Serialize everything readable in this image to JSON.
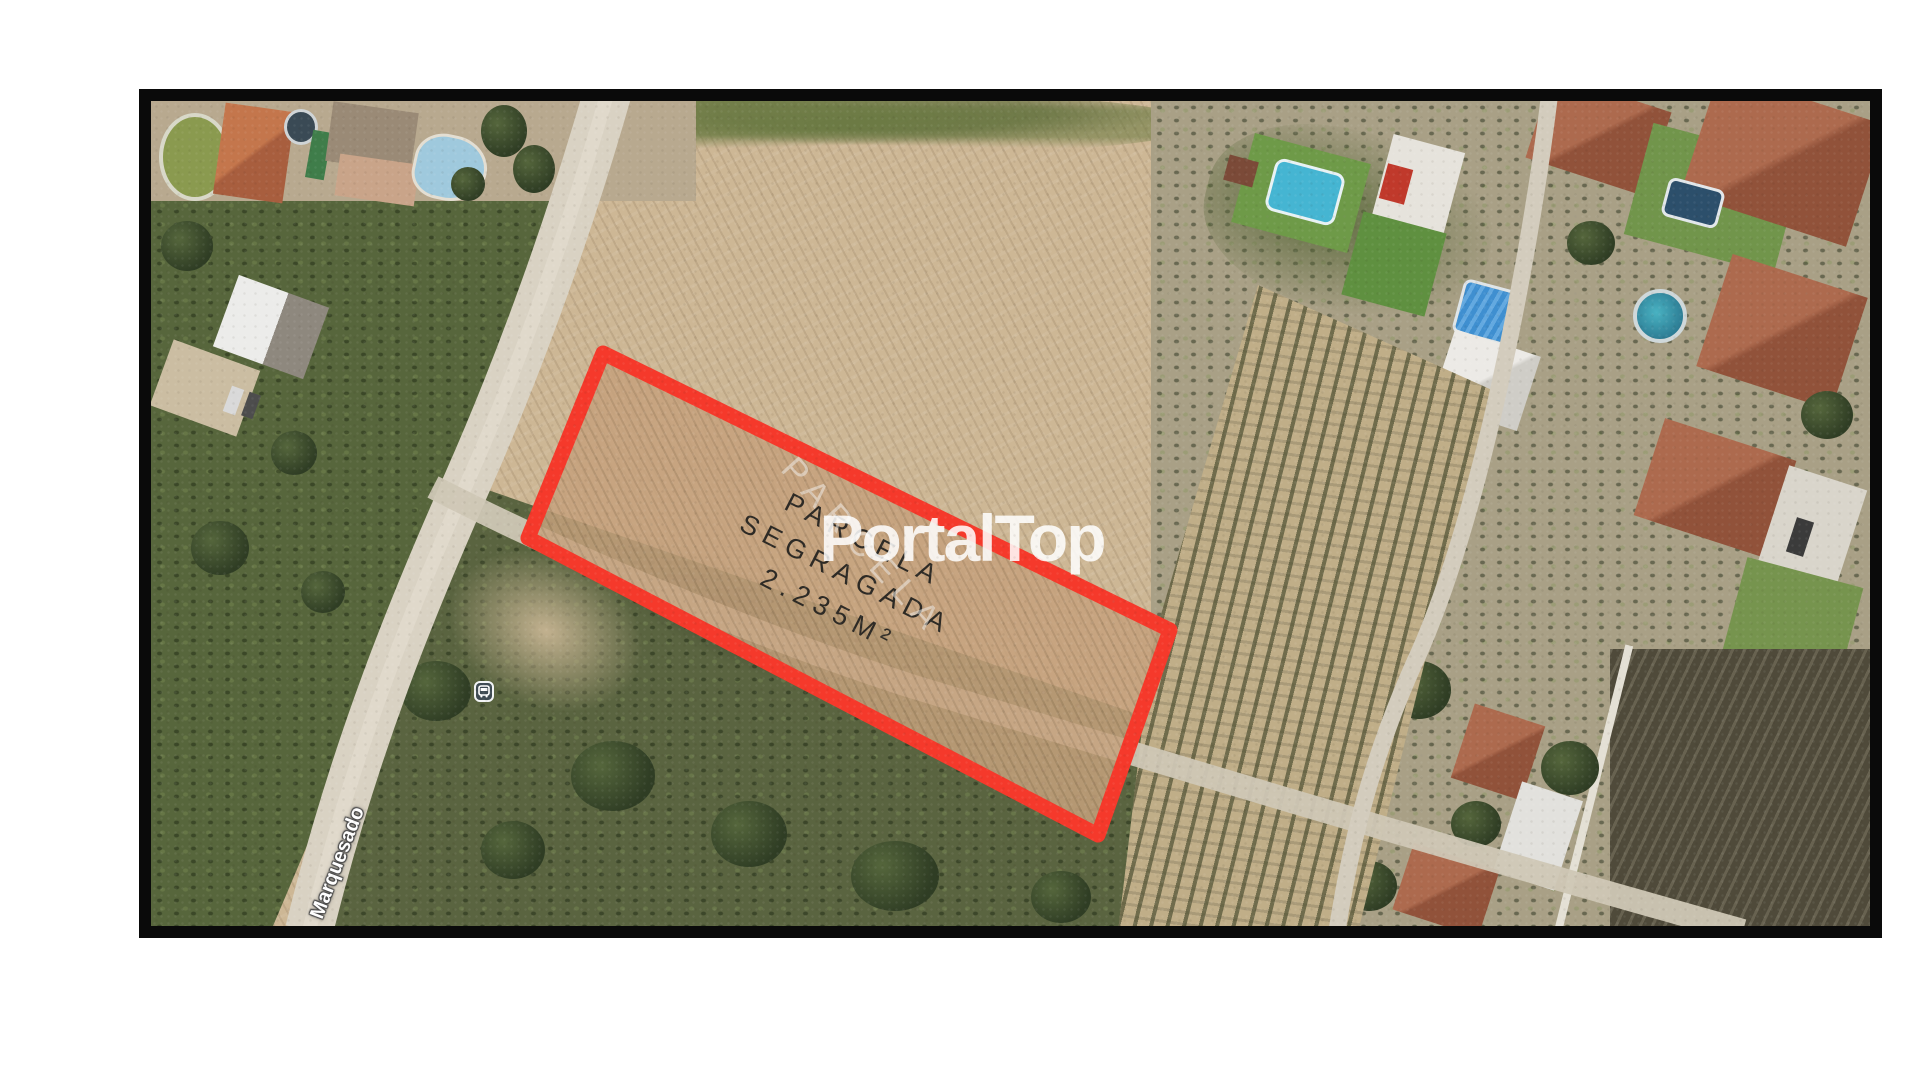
{
  "image": {
    "type": "aerial-property-photo"
  },
  "frame": {
    "border_color": "#0a0a0a",
    "page_background": "#ffffff"
  },
  "labels": {
    "parcel": {
      "line1": "PARCELA",
      "line2": "SEGRAGADA",
      "line3": "2.235M²",
      "color": "#2d2a25"
    },
    "parcel_ghost": {
      "text": "PARCELA"
    },
    "street": {
      "text": "Marquesado"
    },
    "watermark": {
      "text": "PortalTop",
      "color": "#ffffff"
    }
  },
  "parcel_outline": {
    "color": "#f5392b"
  },
  "icons": {
    "bus_stop": "bus-stop-icon"
  }
}
